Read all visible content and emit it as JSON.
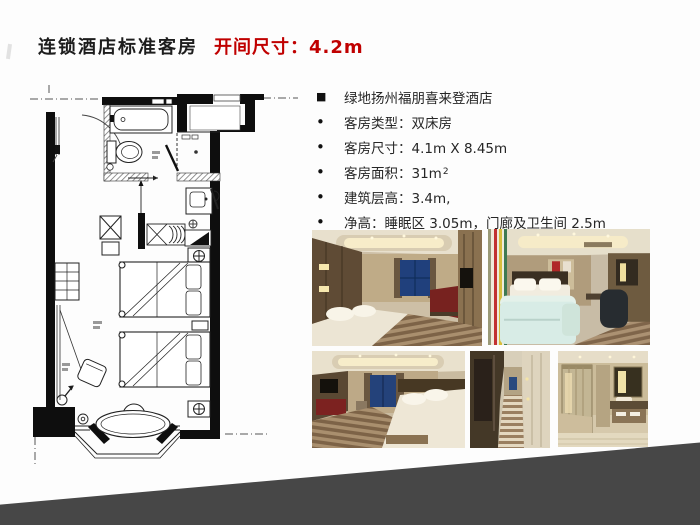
{
  "slide": {
    "title": "连锁酒店标准客房",
    "headline_dimension": "开间尺寸：4.2m",
    "colors": {
      "accent_red": "#c00000",
      "wedge_gray": "#474747",
      "ink": "#1d1d1d"
    }
  },
  "specs": {
    "markers": {
      "square": "■",
      "dot": "•"
    },
    "items": [
      {
        "marker": "square",
        "text": "绿地扬州福朋喜来登酒店"
      },
      {
        "marker": "dot",
        "text": "客房类型：双床房"
      },
      {
        "marker": "dot",
        "text": "客房尺寸：4.1m X 8.45m"
      },
      {
        "marker": "dot",
        "text": "客房面积：31m",
        "sup": "2"
      },
      {
        "marker": "dot",
        "text": "建筑层高：3.4m,"
      },
      {
        "marker": "dot",
        "text": "净高：睡眠区 3.05m，门廊及卫生间 2.5m"
      }
    ]
  }
}
